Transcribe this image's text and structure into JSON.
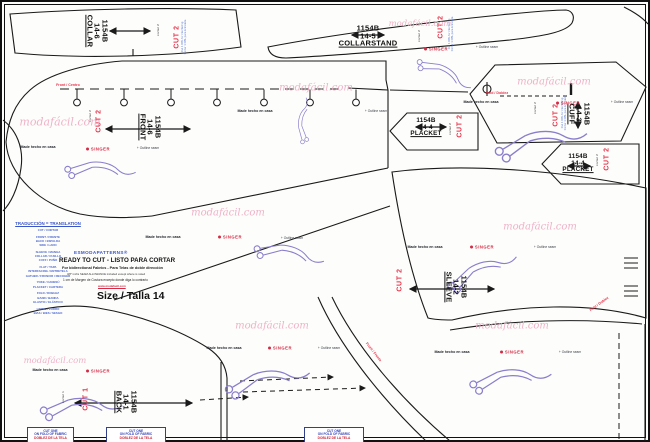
{
  "meta": {
    "watermark": "modafácil.com",
    "brand": "SINGER"
  },
  "labels": {
    "made": "Made hecho en casa",
    "outline_mark": "+ Outline seam",
    "cortar2": "cortar 2",
    "cortar1": "cortar 1",
    "front_center": "Front / Centro",
    "fold": "Fold / Doblez",
    "front_frente": "Front / Frente",
    "interfacing_en": "Cut 1 DBL for interfacing",
    "interfacing_es": "Cortar 1 DBL para Entretela"
  },
  "pieces": {
    "collar": {
      "code": "1154B",
      "num": "14-6",
      "name": "COLLAR",
      "cut": "CUT 2"
    },
    "collarstand": {
      "code": "1154B",
      "num": "14-5",
      "name": "COLLARSTAND",
      "cut": "CUT 2"
    },
    "cuff": {
      "code": "1154B",
      "num": "14-3",
      "name": "CUFF",
      "cut": "CUT 2"
    },
    "front": {
      "code": "1154B",
      "num": "14-6",
      "name": "FRONT",
      "cut": "CUT 2"
    },
    "placket_a": {
      "code": "1154B",
      "num": "14-4",
      "name": "PLACKET",
      "cut": "CUT 2"
    },
    "placket_b": {
      "code": "1154B",
      "num": "14-4",
      "name": "PLACKET",
      "cut": "CUT 2"
    },
    "sleeve": {
      "code": "1154B",
      "num": "14-2",
      "name": "SLEEVE",
      "cut": "CUT 2"
    },
    "back": {
      "code": "1154B",
      "num": "14-1",
      "name": "BACK",
      "cut": "CUT 1"
    }
  },
  "fold_box": {
    "line1": "CUT ONE",
    "line2": "ON FOLD OF FABRIC",
    "line3": "DOBLEZ DE LA TELA"
  },
  "translation": {
    "title": "TRADUCCIÓN = TRANSLATION",
    "lines": [
      "CUT / CORTAR",
      "FRONT / FRENTE",
      "BACK / ESPALDA",
      "SIDE / LADO",
      "SLEEVE / MANGA",
      "COLLAR / CUELLO",
      "CUFF / PUÑO",
      "FLAT / TAPA",
      "INTERFACING / ENTRETELA",
      "GATHER / FRUNCIR / RECOGER",
      "YOKE / CANESÚ",
      "PLACKET / CARTERA",
      "FOLD / DOBLEZ",
      "BAND / BANDA",
      "ELASTIC / ELÁSTICO",
      "LINING / FORRO",
      "BIAS / BIES / SESGO"
    ]
  },
  "info": {
    "brand": "ESMODAPATTERNS®",
    "ready": "READY TO CUT  -  LISTO PARA CORTAR",
    "fabrics": "For bidirectional Fabrics - Para Telas de doble dirección",
    "seam_en": "3/8\" inchs SEAM ALLOWANCE included except where is noted",
    "seam_es": "1 cm de Margen de Costura excepto donde diga lo contrario",
    "url": "www.modafacil.com",
    "size": "Size / Talla  14"
  }
}
